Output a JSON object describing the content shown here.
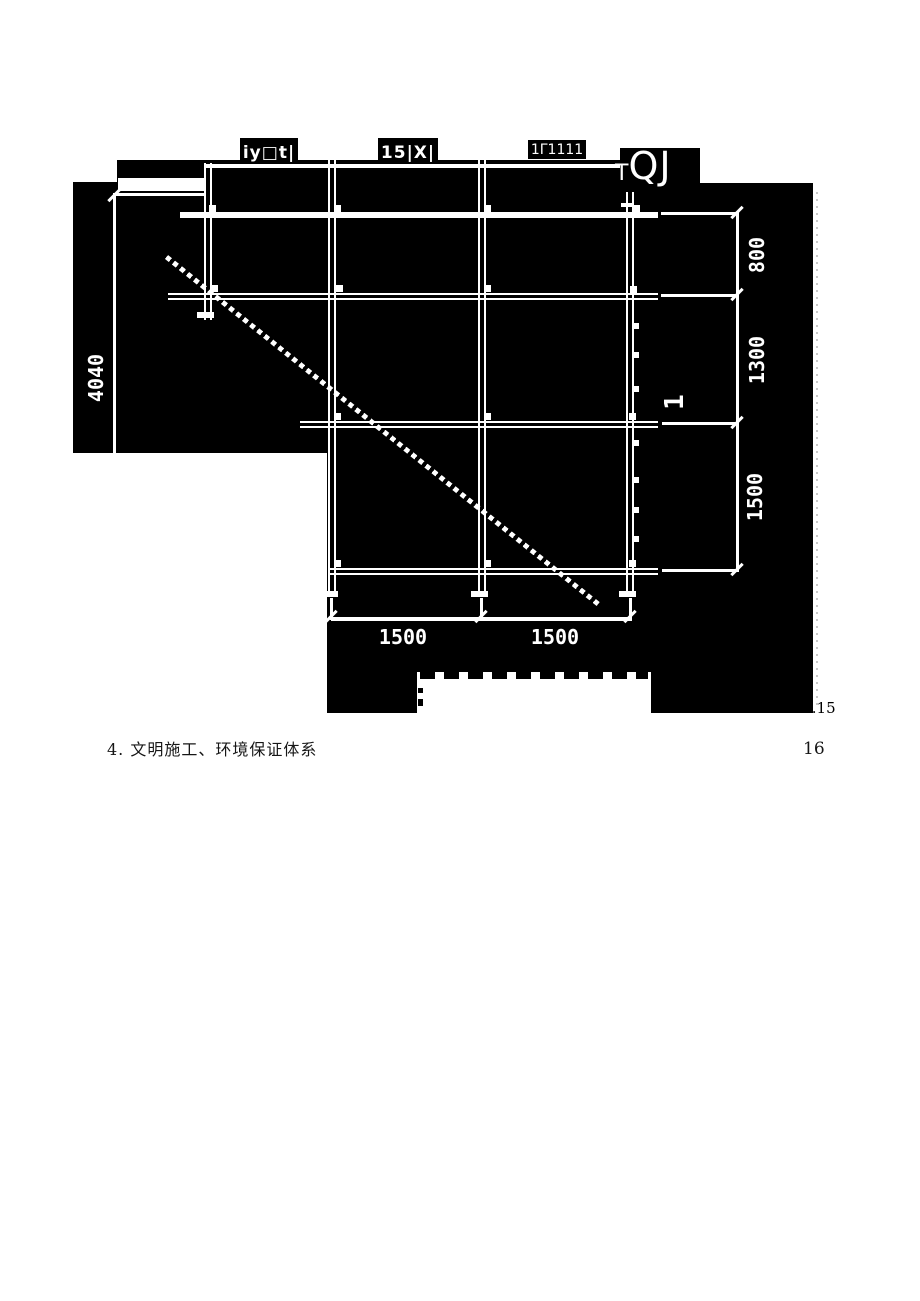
{
  "figure": {
    "top_boxes": [
      {
        "label": "iy□t|"
      },
      {
        "label": "15|X|"
      },
      {
        "label": "1Γ1111"
      }
    ],
    "corner_label": {
      "t": "T",
      "qj": "QJ"
    },
    "dimensions": {
      "left_vertical": "4040",
      "right_vertical": [
        "800",
        "1300",
        "1500"
      ],
      "right_inner": "1",
      "bottom": [
        "1500",
        "1500"
      ]
    },
    "corner_note": "..15"
  },
  "document": {
    "heading": "4. 文明施工、环境保证体系",
    "page_number": "16"
  },
  "colors": {
    "ink": "#000000",
    "line": "#ffffff",
    "page": "#ffffff"
  }
}
